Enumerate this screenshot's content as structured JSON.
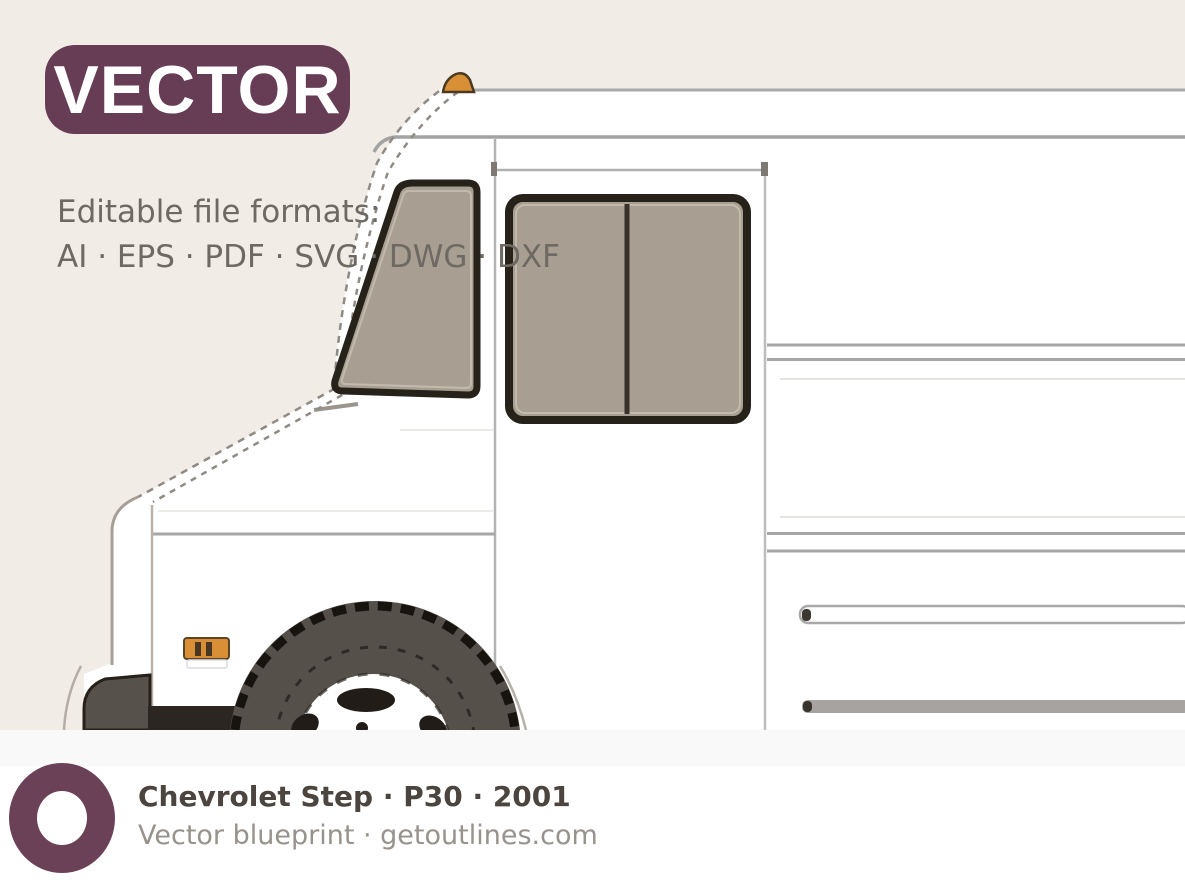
{
  "badge": {
    "label": "VECTOR"
  },
  "formats": {
    "line1": "Editable file formats:",
    "line2": "AI · EPS · PDF · SVG · DWG · DXF"
  },
  "vehicle": {
    "make": "Chevrolet",
    "type": "Step",
    "model": "P30",
    "year": "2001"
  },
  "footer": {
    "title": "Chevrolet Step · P30 · 2001",
    "subtitle": "Vector blueprint · getoutlines.com",
    "logo_icon": "donut-ring-icon"
  },
  "drawing": {
    "subject": "step van side view, front half",
    "elements": [
      "windshield",
      "door-window",
      "front-wheel",
      "front-bumper",
      "side-marker-light",
      "roof-marker-light",
      "body-panel-lines",
      "rub-rails"
    ]
  },
  "theme": {
    "background": "#f1ede6",
    "badge_purple": "#663d55",
    "logo_purple": "#6b4158",
    "title_color": "#4c443e",
    "muted_text": "#97928c",
    "formats_text": "#6e6963",
    "window_glass": "#a89f92",
    "line_gray": "#a8a8a8",
    "dark_outline": "#262119",
    "tire_gray": "#56504a",
    "marker_orange": "#d98f35",
    "footer_background": "#ffffff"
  }
}
